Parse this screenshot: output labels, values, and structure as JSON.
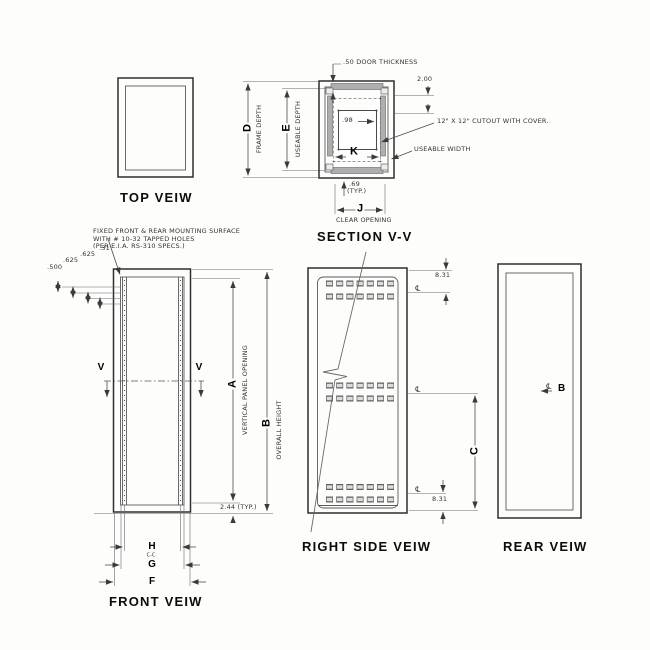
{
  "drawing": {
    "top_view": {
      "title": "TOP VEIW"
    },
    "depth_dims": {
      "d": "D",
      "d_desc": "FRAME DEPTH",
      "e": "E",
      "e_desc": "USEABLE DEPTH"
    },
    "section_view": {
      "title": "SECTION V-V",
      "door_thickness": ".50 DOOR THICKNESS",
      "top_offset": "2.00",
      "panel_offset": ".98",
      "cutout_note": "12\" X 12\" CUTOUT WITH COVER.",
      "useable_width": "USEABLE WIDTH",
      "k": "K",
      "flange": ".69",
      "flange_typ": "(TYP.)",
      "j": "J",
      "clear_opening": "CLEAR OPENING"
    },
    "front_view": {
      "title": "FRONT VEIW",
      "note": [
        "FIXED FRONT & REAR MOUNTING SURFACE",
        "WITH # 10-32 TAPPED HOLES",
        "(PER E.I.A. RS-310 SPECS.)"
      ],
      "offsets": [
        ".500",
        ".625",
        ".625",
        ".31"
      ],
      "cut_letter": "V",
      "a": "A",
      "a_desc": "VERTICAL PANEL OPENING",
      "b": "B",
      "b_desc": "OVERALL HEIGHT",
      "bottom_offset": "2.44 (TYP.)",
      "h": "H",
      "h_sub": "C-C",
      "g": "G",
      "f": "F"
    },
    "right_view": {
      "title": "RIGHT SIDE VEIW",
      "top_dim": "8.31",
      "bottom_dim": "8.31",
      "c": "C",
      "centerline": "℄"
    },
    "rear_view": {
      "title": "REAR VEIW",
      "centerline": "℄",
      "b_ref": "B"
    }
  }
}
